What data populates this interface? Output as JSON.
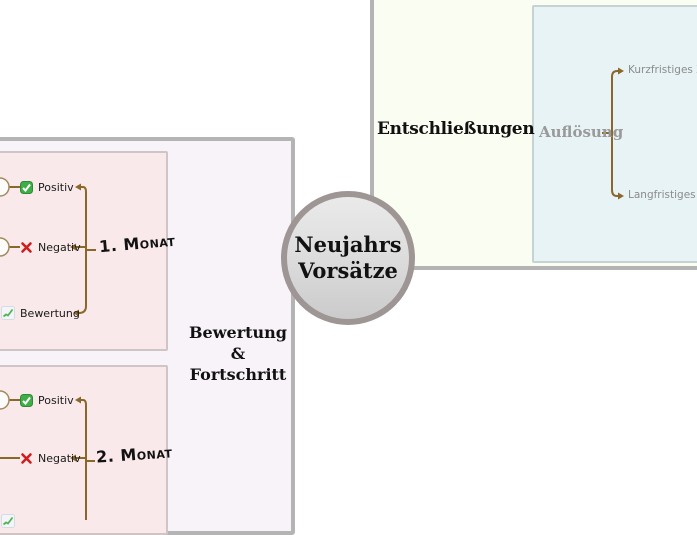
{
  "center_topic": {
    "line1": "Neujahrs",
    "line2": "Vorsätze"
  },
  "resolutions": {
    "title": "Entschließungen",
    "node": "Auflösung",
    "children": [
      {
        "label": "Kurzfristiges Zi"
      },
      {
        "label": "Langfristiges Zi"
      }
    ]
  },
  "evaluation": {
    "title_line1": "Bewertung",
    "title_line2": "&",
    "title_line3": "Fortschritt",
    "months": [
      {
        "label": "1. Monat",
        "items": [
          {
            "icon": "check-icon",
            "label": "Positiv"
          },
          {
            "icon": "cross-icon",
            "label": "Negativ"
          },
          {
            "icon": "chart-icon",
            "label": "Bewertung"
          }
        ]
      },
      {
        "label": "2. Monat",
        "items": [
          {
            "icon": "check-icon",
            "label": "Positiv"
          },
          {
            "icon": "cross-icon",
            "label": "Negativ"
          }
        ]
      }
    ]
  },
  "colors": {
    "positive_green": "#2f9e33",
    "negative_red": "#cc1f1f",
    "connector_brown": "#8a682c",
    "node_ring_brown": "#a18a5e",
    "panel_left_bg": "#f8f2f9",
    "panel_month_bg": "#f9e9ea",
    "panel_resolutions_bg": "#fafdf2",
    "panel_auflosung_bg": "#e8f3f6",
    "panel_border_gray": "#b4b4b4",
    "center_node_border": "#9e9595",
    "muted_text": "#8b8b8b"
  }
}
